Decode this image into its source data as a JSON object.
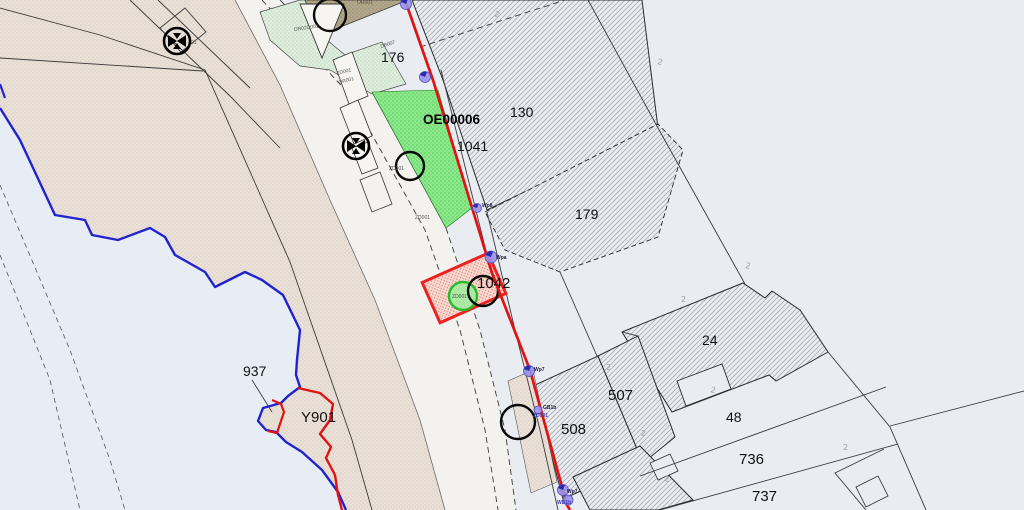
{
  "map": {
    "kind_label": "cadastral parcel map view",
    "labels": {
      "p176": "176",
      "oe_code": "OE00006",
      "p1041": "1041",
      "p130": "130",
      "p179": "179",
      "p1042": "1042",
      "p24": "24",
      "p507": "507",
      "p508": "508",
      "p48": "48",
      "p736": "736",
      "p737": "737",
      "p937": "937",
      "y901": "Y901"
    },
    "small_labels": {
      "or02d001": "OR02D001",
      "zd001_a": "ZD001",
      "or001_a": "OR001",
      "db007": "DB007",
      "or001_top": "OR001",
      "zd001_b": "ZD001",
      "zd001_c": "ZD001",
      "zd001_circle": "ZD001",
      "valve_01": "01",
      "wpa": "Wpa",
      "wp8": "Wp8",
      "wp7_a": "Wp7",
      "gb1b": "GB1b",
      "zd001_d": "ZD001",
      "wp7_b": "Wp7",
      "wd1b": "WD1b",
      "fence_glyph": "2"
    },
    "icons": {
      "valve_symbol": "utility-valve-icon",
      "survey_marker": "survey-point-marker",
      "boundary_circle": "boundary-point-circle"
    },
    "colors": {
      "background": "#e9ecf1",
      "water": "#e7edf5",
      "water_line": "#2323cb",
      "red_boundary": "#e01212",
      "highlight_stroke": "#ee2020",
      "highlight_fill": "#f8dcd4",
      "green_circle_stroke": "#2db82d",
      "green_circle_fill": "#9dee9d",
      "bright_green": "#8ce98c",
      "pale_green": "#e0eee0",
      "beige": "#eae2d8",
      "khaki": "#b4a88c",
      "hatch_line": "#a8aebb",
      "road": "#f4f2ee"
    }
  }
}
